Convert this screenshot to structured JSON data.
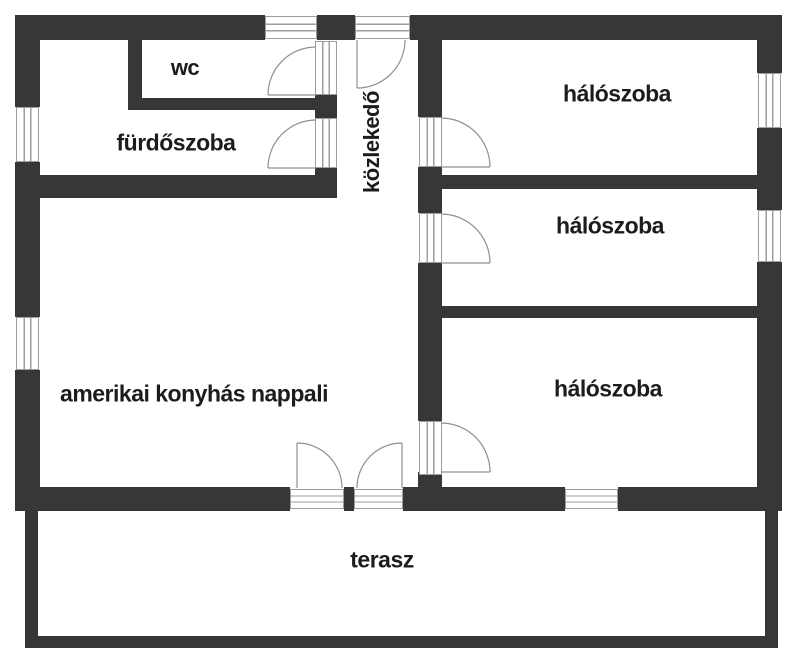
{
  "plan": {
    "kind": "apartment-floor-plan",
    "language": "hu"
  },
  "colors": {
    "wall": "#373737",
    "background": "#ffffff",
    "frame": "#9e9e9e",
    "arc": "#8f8f8f",
    "text": "#1c1c1c"
  },
  "rooms": {
    "wc": {
      "label": "wc"
    },
    "furdoszoba": {
      "label": "fürdőszoba"
    },
    "kozlekedo": {
      "label": "közlekedő"
    },
    "haloszoba_1": {
      "label": "hálószoba"
    },
    "haloszoba_2": {
      "label": "hálószoba"
    },
    "haloszoba_3": {
      "label": "hálószoba"
    },
    "nappali": {
      "label": "amerikai konyhás nappali"
    },
    "terasz": {
      "label": "terasz"
    }
  }
}
